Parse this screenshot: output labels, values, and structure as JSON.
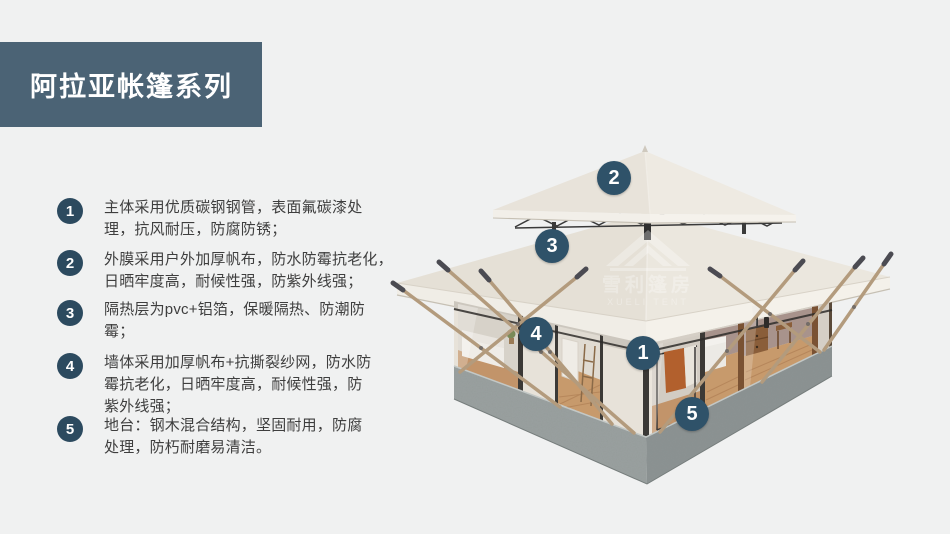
{
  "title": {
    "text": "阿拉亚帐篷系列"
  },
  "features": [
    {
      "num": "1",
      "text": "主体采用优质碳钢钢管，表面氟碳漆处\n理，抗风耐压，防腐防锈；"
    },
    {
      "num": "2",
      "text": "外膜采用户外加厚帆布，防水防霉抗老化，\n日晒牢度高，耐候性强，防紫外线强；"
    },
    {
      "num": "3",
      "text": "隔热层为pvc+铝箔，保暖隔热、防潮防\n霉；"
    },
    {
      "num": "4",
      "text": "墙体采用加厚帆布+抗撕裂纱网，防水防\n霉抗老化，日晒牢度高，耐候性强，防\n紫外线强；"
    },
    {
      "num": "5",
      "text": "地台：钢木混合结构，坚固耐用，防腐\n处理，防朽耐磨易清洁。"
    }
  ],
  "markers": [
    "1",
    "2",
    "3",
    "4",
    "5"
  ],
  "watermark": {
    "cn": "雪利篷房",
    "en": "XUELI TENT"
  },
  "colors": {
    "background": "#f0f1f1",
    "title_banner": "#4b6375",
    "badge": "#2c4a5f",
    "marker": "#2f5269",
    "body_text": "#3e3e3e",
    "roof_canvas": "#e9e5dc",
    "base_concrete": "#939a99",
    "pole_wood": "#b39b7d"
  }
}
